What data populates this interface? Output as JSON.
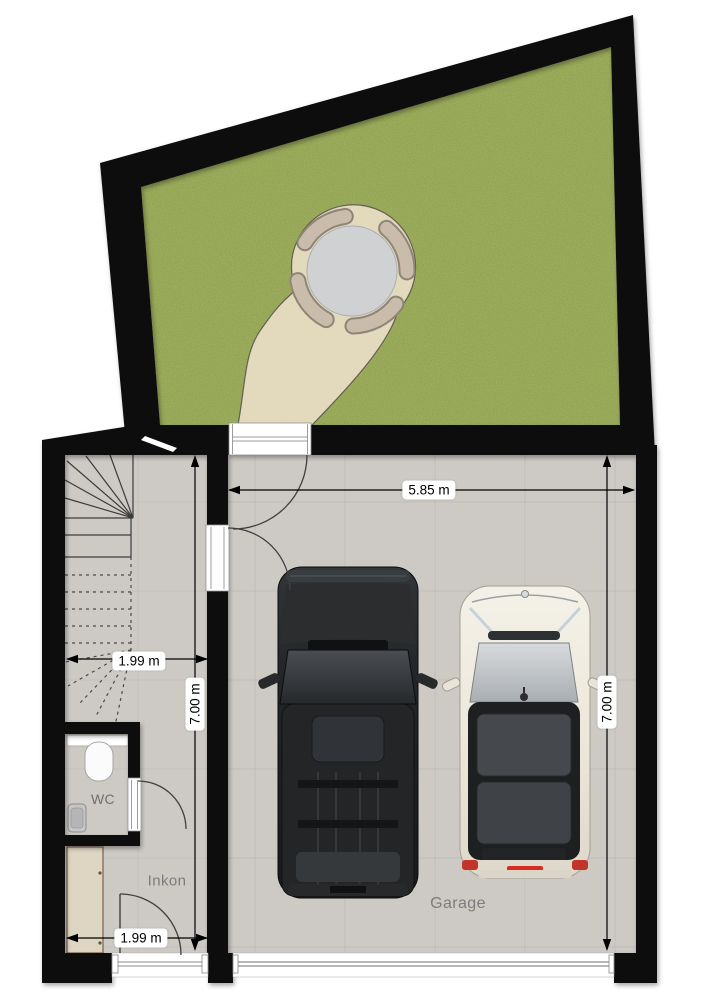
{
  "plan_type": "floor-plan-ground-level",
  "rooms": {
    "wc": "WC",
    "entrance": "Inkon",
    "garage": "Garage"
  },
  "dimensions": {
    "garage_width": "5.85 m",
    "depth_left": "7.00 m",
    "depth_right": "7.00 m",
    "entrance_width_upper": "1.99 m",
    "entrance_width_lower": "1.99 m"
  },
  "objects": {
    "garden": "lawn-garden",
    "terrace": "round-gravel-terrace-with-table-and-four-chairs",
    "path": "curved-sand-garden-path",
    "stairs": "winder-staircase",
    "toilet": "toilet",
    "sink": "hand-basin",
    "wardrobe": "closet-cabinet",
    "car_left": "black-suv-top-view",
    "car_right": "white-hatchback-top-view",
    "garden_door": "garden-door-swing",
    "interior_door": "hall-to-garage-door-swing",
    "wc_door": "wc-door-swing",
    "front_door": "front-entrance-door-swing",
    "garage_door": "garage-sectional-door"
  },
  "colors": {
    "wall": "#0d0d0d",
    "grass": "#83973d",
    "path_sand": "#e4dabb",
    "terrace_table": "#d2d4d6",
    "chair": "#c9bcab",
    "floor": "#cdcac4",
    "tile_line": "#b7b4ae",
    "black_car": "#222426",
    "white_car": "#efece1",
    "taillight_red": "#c2342a",
    "dimension_text": "#000000",
    "room_label_text": "#7c7c7c"
  }
}
